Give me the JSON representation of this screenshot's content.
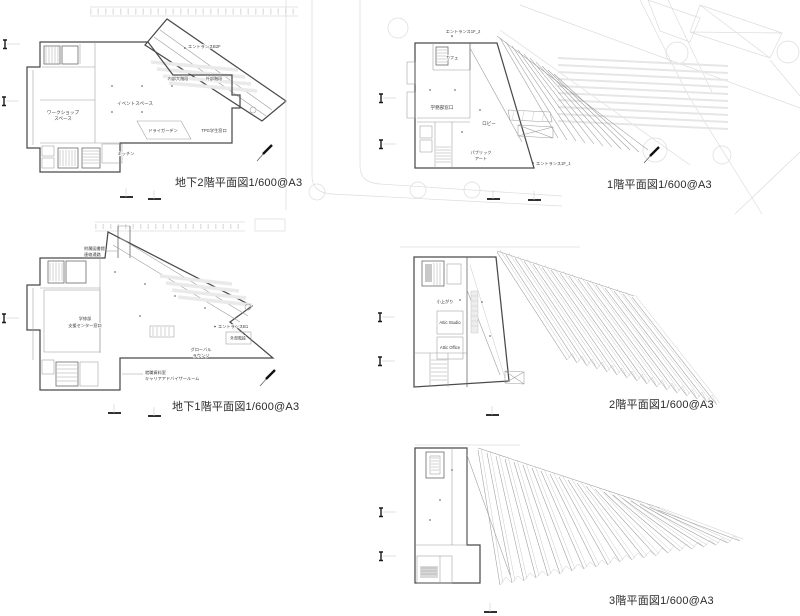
{
  "sheet": {
    "background": "#ffffff",
    "wall_color": "#4a4a4a",
    "line_color": "#9b9b9b",
    "site_color": "#dcdcdc",
    "label_color": "#3a3a3a",
    "title_color": "#2b2b2b"
  },
  "icons": {
    "slope_arrow": "slope-arrow",
    "section_marker": "section-marker",
    "survey_tick": "survey-tick",
    "tree": "tree-circle"
  },
  "plans": {
    "b2": {
      "title": "地下2階平面図1/600@A3",
      "labels": {
        "entrance": "エントランスB2F",
        "inner_stair": "内部大階段",
        "outer_stair": "外部階段",
        "event_space": "イベントスペース",
        "workshop_line1": "ワークショップ",
        "workshop_line2": "スペース",
        "dry_garden": "ドライガーデン",
        "tpg_window": "TPG学生窓口",
        "kitchen": "キッチン"
      }
    },
    "f1": {
      "title": "1階平面図1/600@A3",
      "labels": {
        "entrance_2": "エントランス1F_2",
        "cafe": "カフェ",
        "gakumu_window": "学務部窓口",
        "lobby": "ロビー",
        "public_art_line1": "パブリック",
        "public_art_line2": "アート",
        "entrance_1": "エントランス1F_1"
      }
    },
    "b1": {
      "title": "地下1階平面図1/600@A3",
      "labels": {
        "library_line1": "附属図書館",
        "library_line2": "連絡通路",
        "support_line1": "学修部",
        "support_line2": "支援センター窓口",
        "entrance": "エントランスB1",
        "outer_stair": "外部階段",
        "global_line1": "グローバル",
        "global_line2": "ラウンジ",
        "career_line1": "就職資料室",
        "career_line2": "キャリアアドバイザールーム"
      }
    },
    "f2": {
      "title": "2階平面図1/600@A3",
      "labels": {
        "koagari": "小上がり",
        "attic_studio": "Attic Studio",
        "attic_office": "Attic Office"
      }
    },
    "f3": {
      "title": "3階平面図1/600@A3",
      "labels": {}
    }
  }
}
